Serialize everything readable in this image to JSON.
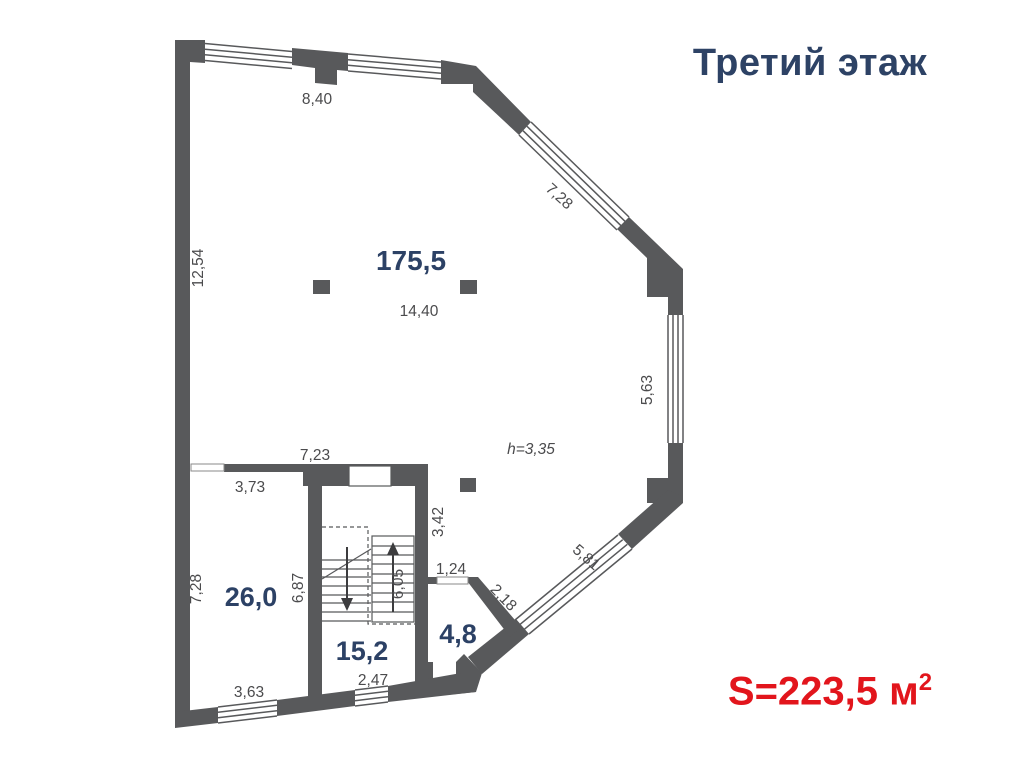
{
  "header": {
    "title": "Третий этаж"
  },
  "footer": {
    "area_prefix": "S=223,5 м",
    "area_sup": "2"
  },
  "rooms": {
    "main": {
      "area": "175,5"
    },
    "room26": {
      "area": "26,0"
    },
    "stair": {
      "area": "15,2"
    },
    "small": {
      "area": "4,8"
    }
  },
  "dimensions": {
    "top_wall": "8,40",
    "diag_top_right": "7,28",
    "left_wall": "12,54",
    "main_room_width": "14,40",
    "right_wall": "5,63",
    "ceiling_height": "h=3,35",
    "partition_width": "7,23",
    "room26_top": "3,73",
    "stair_right_upper": "3,42",
    "small_room_opening": "1,24",
    "small_room_diag": "2,18",
    "diag_bottom_right": "5,81",
    "room26_left": "7,28",
    "room26_right": "6,87",
    "stair_flight": "6,05",
    "stair_bottom_window": "2,47",
    "room26_bottom_window": "3,63"
  },
  "colors": {
    "wall": "#58595b",
    "dimension_text": "#4b4b4d",
    "room_label": "#2c4165",
    "title": "#2d4265",
    "accent_red": "#e2151c"
  }
}
